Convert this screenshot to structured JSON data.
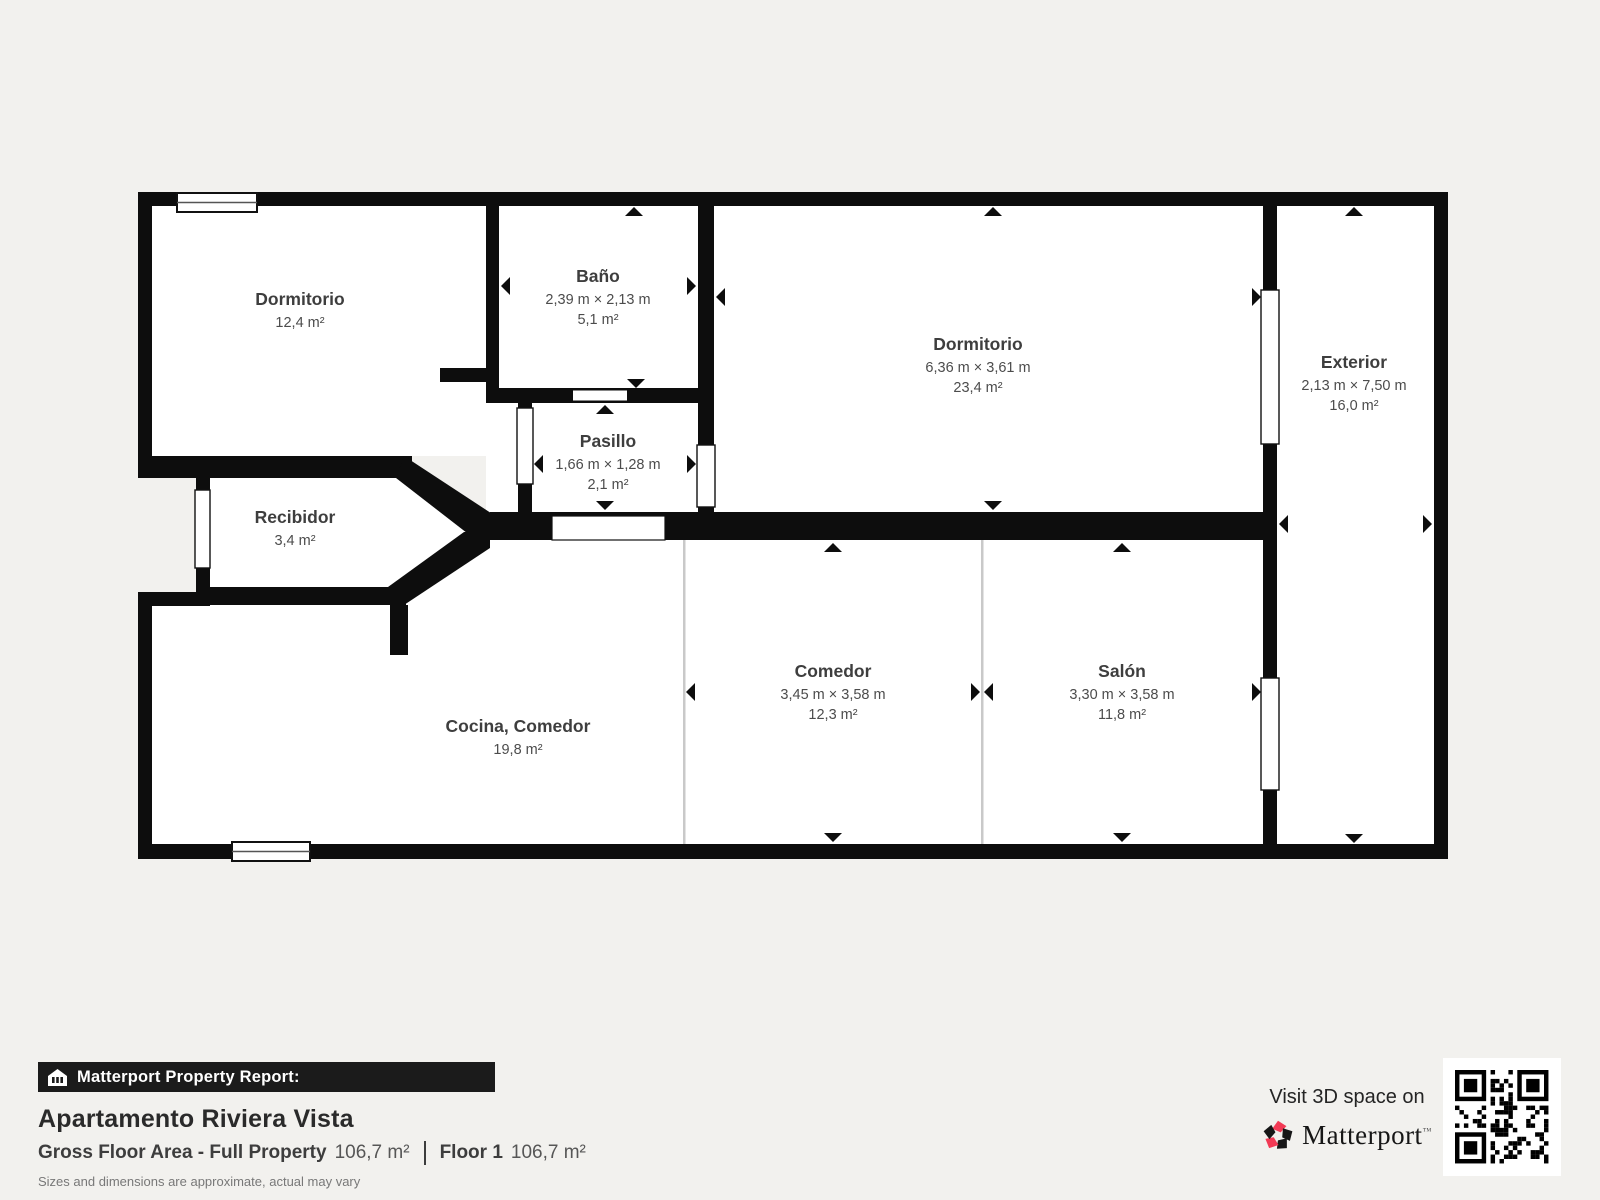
{
  "plan": {
    "rooms": [
      {
        "id": "dormitorio1",
        "name": "Dormitorio",
        "dims": "",
        "area": "12,4 m²"
      },
      {
        "id": "bano",
        "name": "Baño",
        "dims": "2,39 m × 2,13 m",
        "area": "5,1 m²"
      },
      {
        "id": "dormitorio2",
        "name": "Dormitorio",
        "dims": "6,36 m × 3,61 m",
        "area": "23,4 m²"
      },
      {
        "id": "exterior",
        "name": "Exterior",
        "dims": "2,13 m × 7,50 m",
        "area": "16,0 m²"
      },
      {
        "id": "pasillo",
        "name": "Pasillo",
        "dims": "1,66 m × 1,28 m",
        "area": "2,1 m²"
      },
      {
        "id": "recibidor",
        "name": "Recibidor",
        "dims": "",
        "area": "3,4 m²"
      },
      {
        "id": "cocina_comedor",
        "name": "Cocina, Comedor",
        "dims": "",
        "area": "19,8 m²"
      },
      {
        "id": "comedor",
        "name": "Comedor",
        "dims": "3,45 m × 3,58 m",
        "area": "12,3 m²"
      },
      {
        "id": "salon",
        "name": "Salón",
        "dims": "3,30 m × 3,58 m",
        "area": "11,8 m²"
      }
    ]
  },
  "footer": {
    "report_label": "Matterport Property Report:",
    "property_name": "Apartamento Riviera Vista",
    "gfa_label": "Gross Floor Area - Full Property",
    "gfa_value": "106,7 m²",
    "floor_label": "Floor 1",
    "floor_value": "106,7 m²",
    "disclaimer": "Sizes and dimensions are approximate, actual may vary"
  },
  "cta": {
    "visit_text": "Visit 3D space on",
    "brand": "Matterport",
    "brand_mark": "™"
  },
  "colors": {
    "wall": "#0d0d0d",
    "background": "#f2f1ee",
    "accent_red": "#f23a55",
    "divider_gray": "#c9c9c9"
  }
}
